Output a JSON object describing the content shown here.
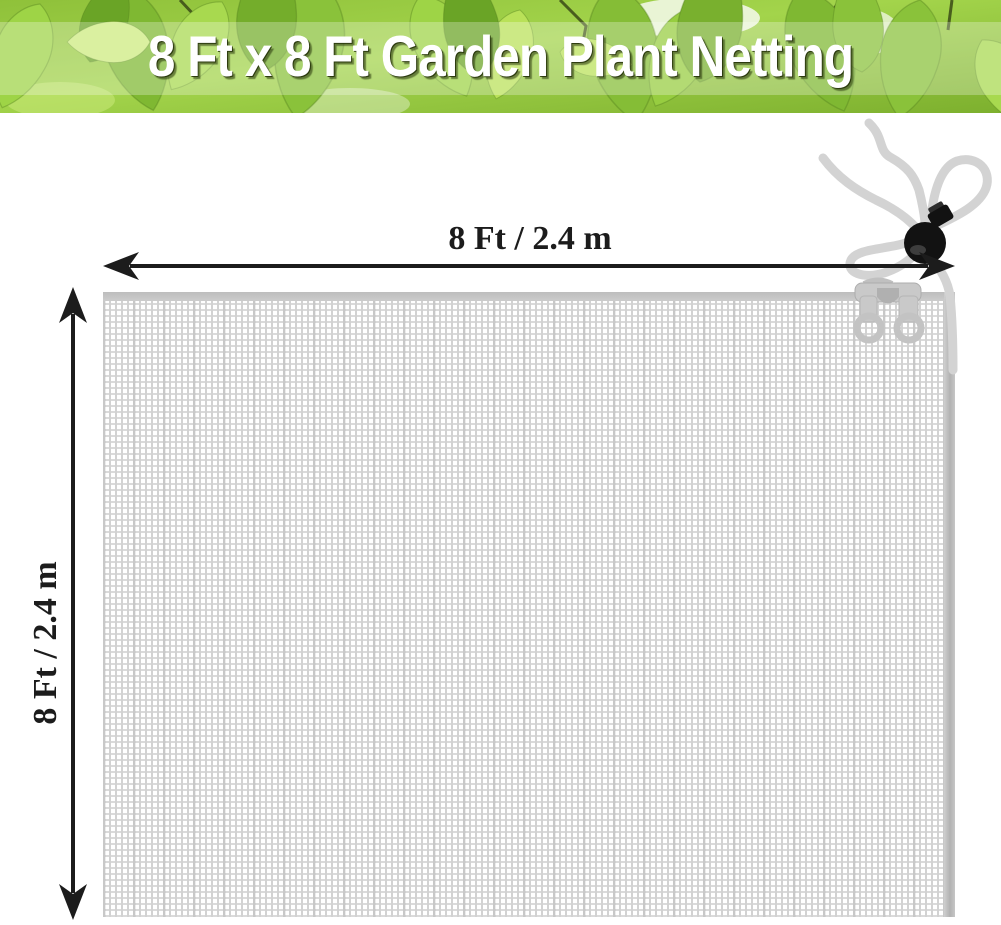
{
  "banner": {
    "title": "8 Ft x 8 Ft Garden Plant Netting"
  },
  "diagram": {
    "width_label": "8 Ft / 2.4 m",
    "height_label": "8 Ft / 2.4 m"
  },
  "parts": {
    "netting_mesh": "fine white square-mesh netting panel",
    "drawstring": "gray drawstring tie cord",
    "cord_lock": "black ball cord-lock toggle",
    "edge_clip": "gray edge clip with two rings"
  },
  "colors": {
    "banner_green": "#8cc63f",
    "banner_green_dark": "#6aa32a",
    "title_text": "#ffffff",
    "dimension_text": "#1c1c1c",
    "arrow": "#1c1c1c",
    "mesh_line": "#d4d4d4",
    "mesh_edge": "#bfbfbf",
    "cord_gray": "#d3d3d3",
    "toggle_black": "#141414",
    "background": "#ffffff"
  }
}
